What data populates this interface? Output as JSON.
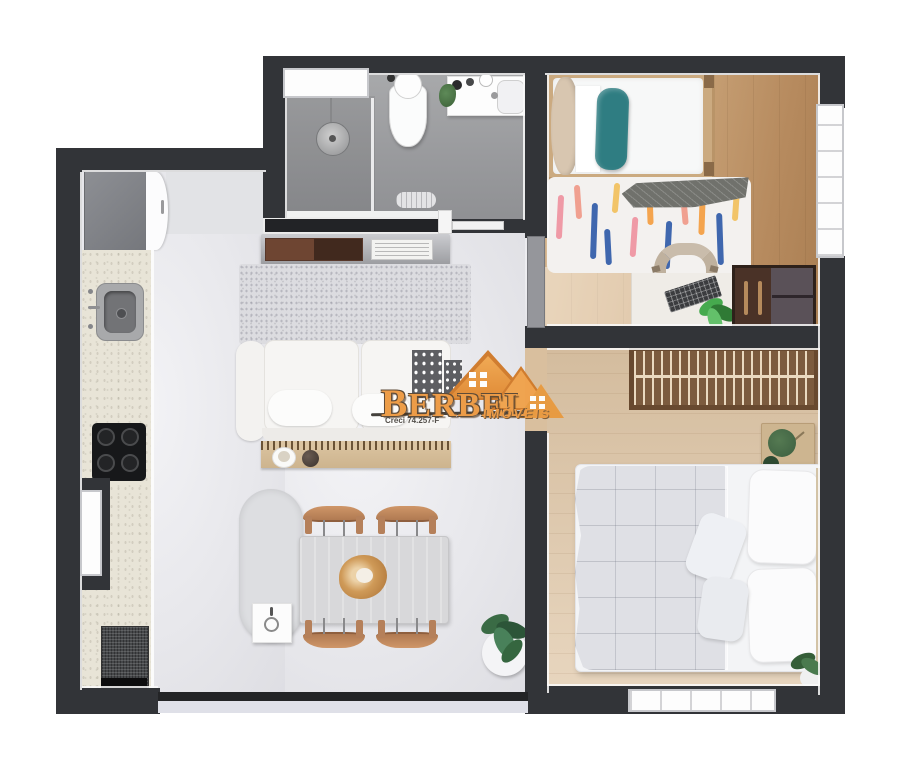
{
  "watermark": {
    "brand": "BERBEL",
    "registration": "Creci 74.257-F",
    "tagline": "IMÓVEIS"
  },
  "palette": {
    "brand_orange": "#ED9A43",
    "wall": "#323438",
    "living_floor": "#E9E9ED",
    "bathroom_floor": "#9FA0A2",
    "bedroom1_floor": "#C49A6F",
    "bedroom2_floor": "#DFC6A6",
    "countertop": "#E8E4D7",
    "pillow_teal": "#2F7D82"
  }
}
